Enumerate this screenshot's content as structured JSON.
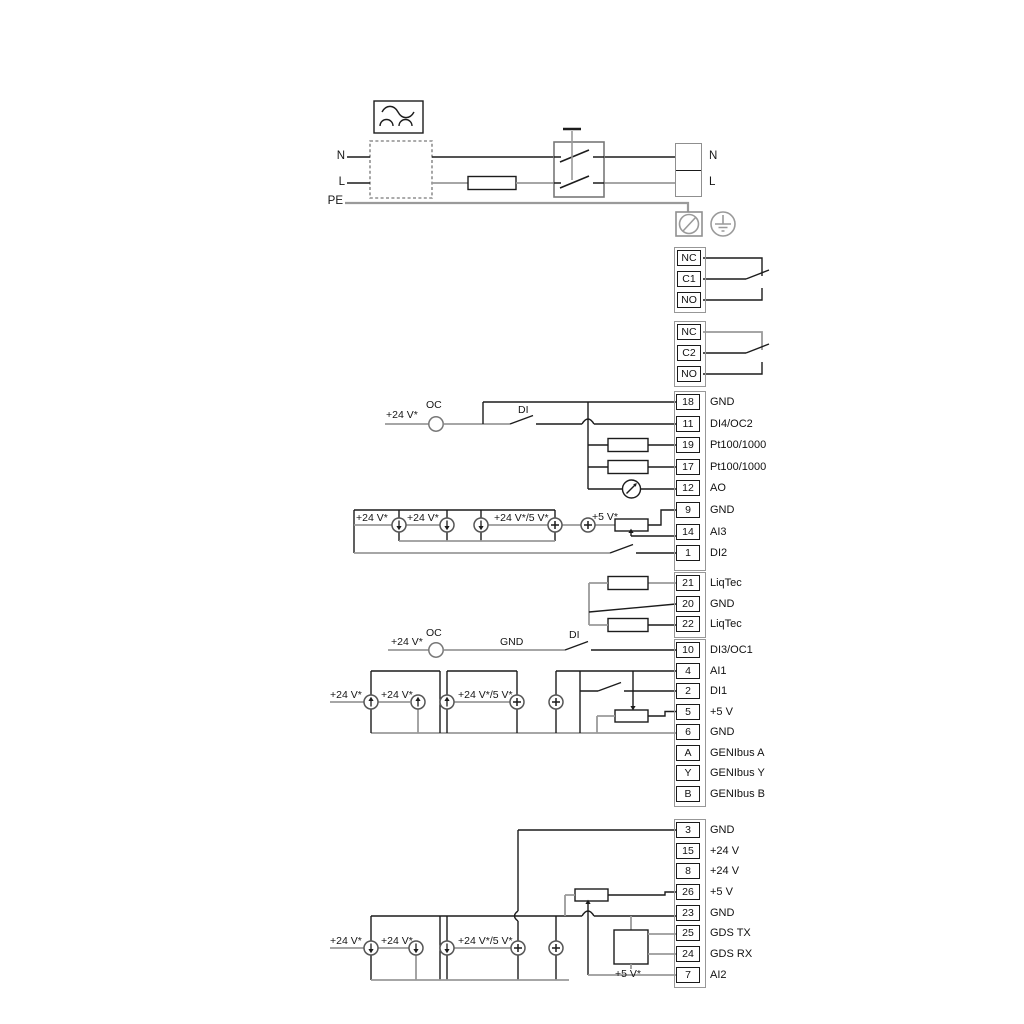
{
  "mains": {
    "n_in": "N",
    "l_in": "L",
    "pe": "PE",
    "n_out": "N",
    "l_out": "L"
  },
  "labels": {
    "plus24": "+24 V*",
    "plus24or5": "+24 V*/5 V*",
    "plus5": "+5 V*",
    "oc": "OC",
    "di": "DI",
    "gnd": "GND"
  },
  "relay1": {
    "cells": [
      "NC",
      "C1",
      "NO"
    ]
  },
  "relay2": {
    "cells": [
      "NC",
      "C2",
      "NO"
    ]
  },
  "strip1": [
    {
      "id": "18",
      "label": "GND"
    },
    {
      "id": "11",
      "label": "DI4/OC2"
    },
    {
      "id": "19",
      "label": "Pt100/1000"
    },
    {
      "id": "17",
      "label": "Pt100/1000"
    },
    {
      "id": "12",
      "label": "AO"
    },
    {
      "id": "9",
      "label": "GND"
    },
    {
      "id": "14",
      "label": "AI3"
    },
    {
      "id": "1",
      "label": "DI2"
    }
  ],
  "liqtec": [
    {
      "id": "21",
      "label": "LiqTec"
    },
    {
      "id": "20",
      "label": "GND"
    },
    {
      "id": "22",
      "label": "LiqTec"
    }
  ],
  "strip2": [
    {
      "id": "10",
      "label": "DI3/OC1"
    },
    {
      "id": "4",
      "label": "AI1"
    },
    {
      "id": "2",
      "label": "DI1"
    },
    {
      "id": "5",
      "label": "+5 V"
    },
    {
      "id": "6",
      "label": "GND"
    },
    {
      "id": "A",
      "label": "GENIbus A"
    },
    {
      "id": "Y",
      "label": "GENIbus Y"
    },
    {
      "id": "B",
      "label": "GENIbus B"
    }
  ],
  "strip3": [
    {
      "id": "3",
      "label": "GND"
    },
    {
      "id": "15",
      "label": "+24 V"
    },
    {
      "id": "8",
      "label": "+24 V"
    },
    {
      "id": "26",
      "label": "+5 V"
    },
    {
      "id": "23",
      "label": "GND"
    },
    {
      "id": "25",
      "label": "GDS TX"
    },
    {
      "id": "24",
      "label": "GDS RX"
    },
    {
      "id": "7",
      "label": "AI2"
    }
  ],
  "colors": {
    "wire_dark": "#1c1c1c",
    "wire_gray": "#9a9a9a",
    "background": "#ffffff"
  }
}
